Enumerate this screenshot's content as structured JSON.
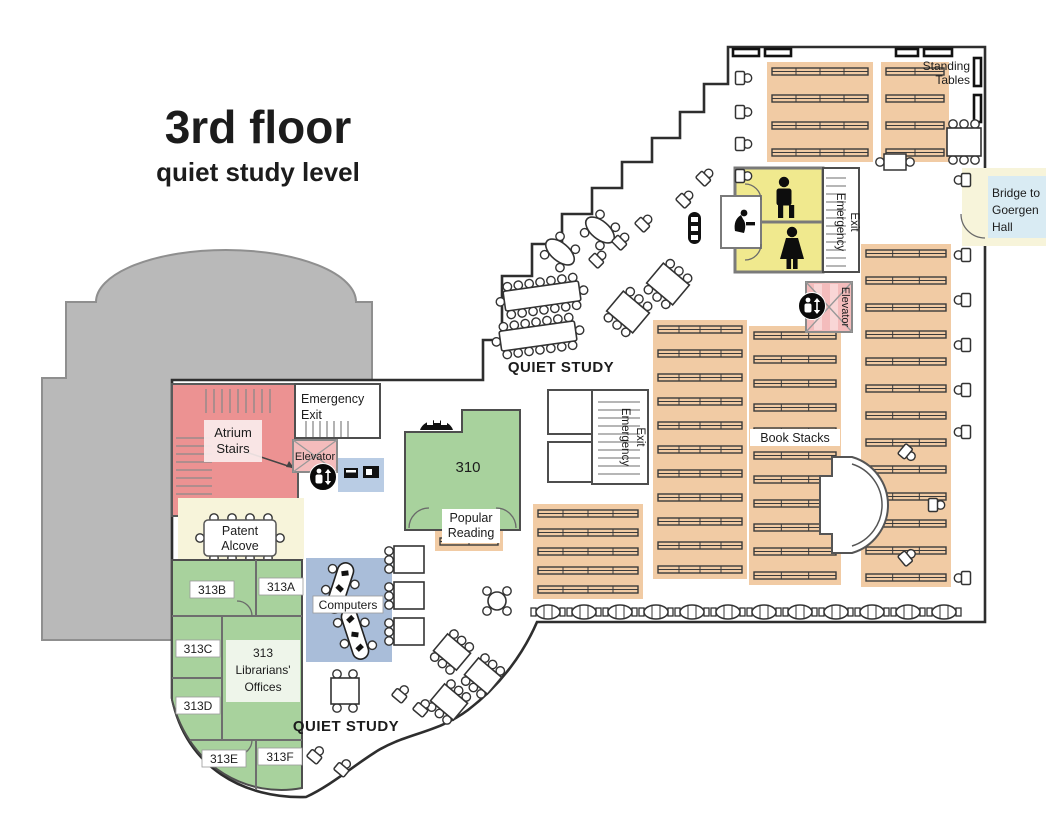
{
  "title": {
    "heading": "3rd floor",
    "subheading": "quiet study level"
  },
  "labels": {
    "standing_tables": [
      "Standing",
      "Tables"
    ],
    "bridge": [
      "Bridge to",
      "Goergen",
      "Hall"
    ],
    "emergency_exit": [
      "Emergency",
      "Exit"
    ],
    "elevator": "Elevator",
    "quiet_study": "QUIET STUDY",
    "book_stacks": "Book Stacks",
    "atrium_stairs": [
      "Atrium",
      "Stairs"
    ],
    "patent_alcove": [
      "Patent",
      "Alcove"
    ],
    "popular_reading": [
      "Popular",
      "Reading"
    ],
    "computers": "Computers",
    "room_310": "310",
    "librarians_offices": [
      "313",
      "Librarians'",
      "Offices"
    ],
    "room_313a": "313A",
    "room_313b": "313B",
    "room_313c": "313C",
    "room_313d": "313D",
    "room_313e": "313E",
    "room_313f": "313F"
  },
  "icons": {
    "male_restroom": "male-figure",
    "female_restroom": "female-figure",
    "drinking_fountain": "person-drinking",
    "elevator": "person-with-up-down-arrows"
  },
  "colors": {
    "atrium_gray": "#b9b9b9",
    "stairs_pink": "#ec9292",
    "elevator_pink": "#f4bcbc",
    "restroom_yellow": "#f0e98e",
    "room_green": "#a8d29d",
    "stacks_tan": "#f1cba4",
    "computers_blue": "#a9bdd9",
    "printer_blue": "#b9cce4",
    "bridge_yellow": "#f7f4da",
    "bridge_blue": "#d9ebf3",
    "wall": "#2e2e2e"
  }
}
